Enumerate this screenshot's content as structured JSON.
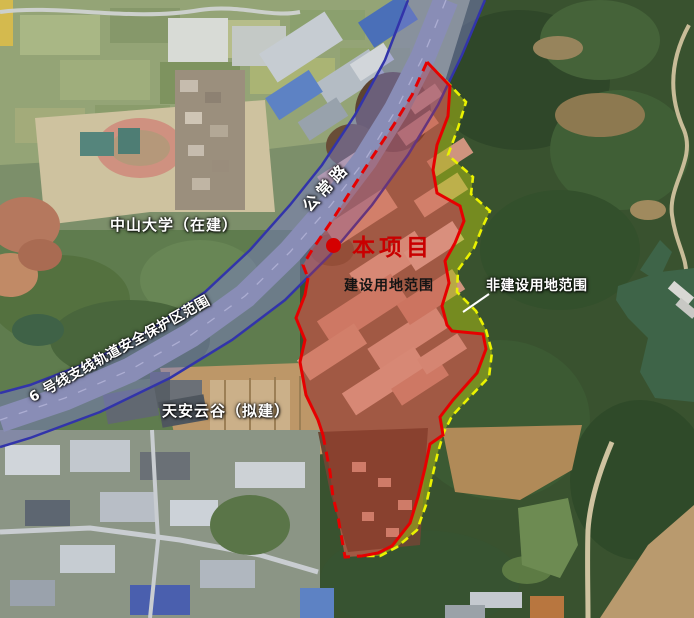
{
  "figure": {
    "type": "satellite-site-location-map",
    "labels": {
      "project_marker": "本项目",
      "construction_area": "建设用地范围",
      "non_construction_area": "非建设用地范围",
      "university": "中山大学（在建）",
      "tianan_cloud_valley": "天安云谷（拟建）",
      "road_name": "公常路",
      "metro_protection_zone": "6 号线支线轨道安全保护区范围"
    },
    "legend_colors": {
      "construction_boundary": "#e60000",
      "non_construction_boundary": "#eaf200",
      "non_construction_fill": "#a8ba14",
      "metro_corridor_fill": "#7b7ec9",
      "metro_corridor_edge": "#3234aa",
      "project_marker_dot": "#d40000"
    }
  }
}
